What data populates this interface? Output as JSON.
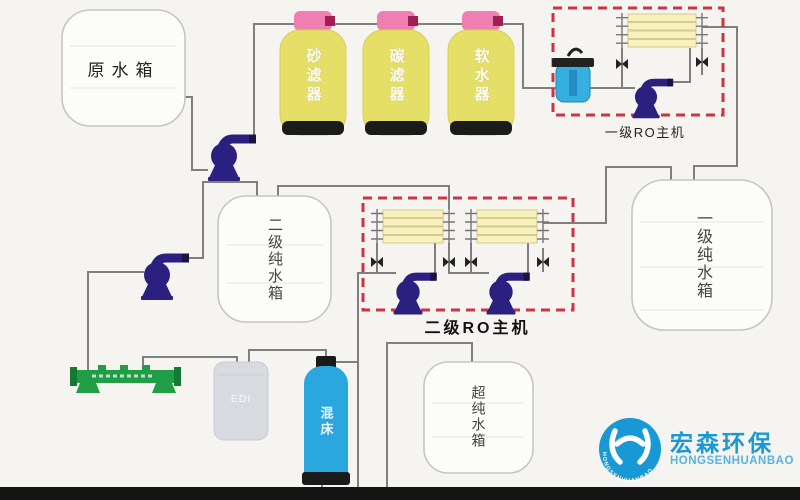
{
  "tanks": {
    "raw_water": {
      "label": "原水箱"
    },
    "stage1_pure": {
      "label": "一级纯水箱"
    },
    "stage2_pure": {
      "label": "二级纯水箱"
    },
    "ultra_pure": {
      "label": "超纯水箱"
    },
    "edi": {
      "label": "EDI"
    },
    "mixed_bed": {
      "label": "混床"
    }
  },
  "filters": [
    {
      "label": "砂滤器"
    },
    {
      "label": "碳滤器"
    },
    {
      "label": "软水器"
    }
  ],
  "ro_units": {
    "stage1": {
      "label": "一级RO主机"
    },
    "stage2": {
      "label": "二级RO主机"
    }
  },
  "logo": {
    "name_cn": "宏森环保",
    "name_en": "HONGSENHUANBAO"
  },
  "colors": {
    "background": "#f5f4f1",
    "pipe": "#7f7f7f",
    "ro_box_border": "#cc3344",
    "filter_body": "#e5de67",
    "filter_cap": "#ef7fb3",
    "pump": "#2b2080",
    "security_filter": "#35aee0",
    "membrane": "#f7f1c1",
    "manifold_green": "#1f9e45",
    "mixed_bed_blue": "#2ba7df",
    "edi_gray": "#d8dae0",
    "logo_blue": "#1899d5",
    "bottom_bar": "#141414"
  }
}
